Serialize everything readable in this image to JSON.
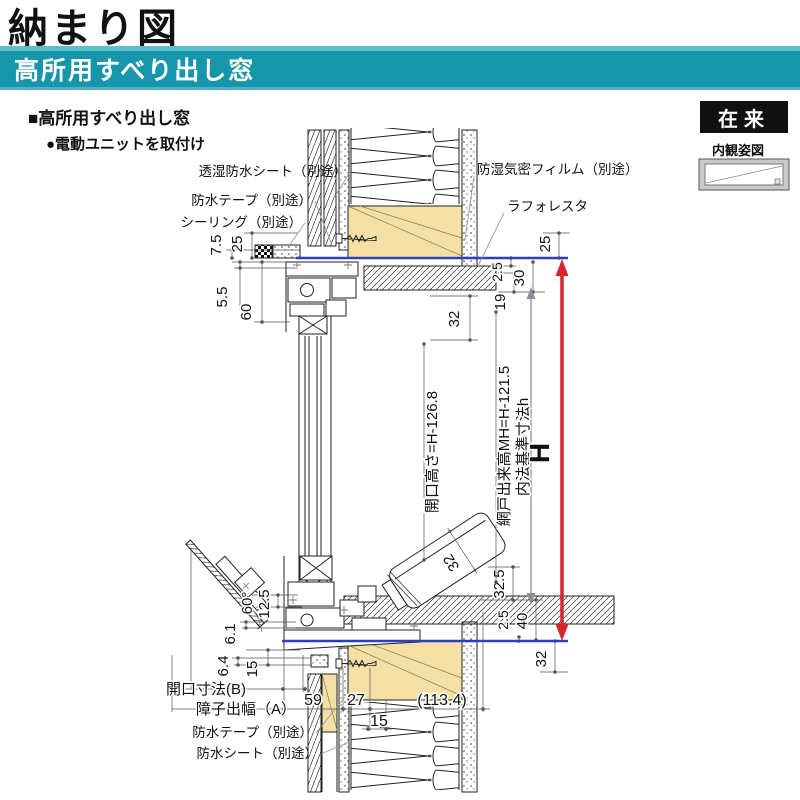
{
  "header": {
    "title": "納まり図",
    "banner": "高所用すべり出し窓",
    "accent_color": "#1796AB"
  },
  "section": {
    "heading": "■高所用すべり出し窓",
    "note": "●電動ユニットを取付け"
  },
  "corner": {
    "badge": "在来",
    "view_label": "内観姿図"
  },
  "callouts": {
    "sheet_top": "透湿防水シート（別途）",
    "tape_top": "防水テープ（別途）",
    "sealing": "シーリング（別途）",
    "film": "防湿気密フィルム（別途）",
    "laforesta": "ラフォレスタ",
    "tape_bottom": "防水テープ（別途）",
    "sheet_bottom": "防水シート（別途）"
  },
  "axis": {
    "opening_h": "開口高さ=H-126.8",
    "screen_h": "網戸出来高MH=H-121.5",
    "naiho": "内法基準寸法h",
    "H": "H"
  },
  "rows": {
    "opening_b": "開口寸法(B)",
    "shoji_a": "障子出幅（A）"
  },
  "dims": {
    "d7_5": "7.5",
    "d25L": "25",
    "d5_5": "5.5",
    "d60": "60",
    "d32head": "32",
    "d2_5t": "2.5",
    "d30": "30",
    "d19": "19",
    "d25R": "25",
    "d32_5": "32.5",
    "d2_5b": "2.5",
    "d40": "40",
    "d32b": "32",
    "d32unit": "32",
    "angle": "60°",
    "d12_5": "12.5",
    "d6_1": "6.1",
    "d6_4": "6.4",
    "d15v": "15",
    "d59": "59",
    "d27": "27",
    "d113": "(113.4)",
    "d15h": "15"
  },
  "colors": {
    "blue_line": "#2B3FC0",
    "red_line": "#D8242A",
    "wood": "#F4E0A4"
  }
}
